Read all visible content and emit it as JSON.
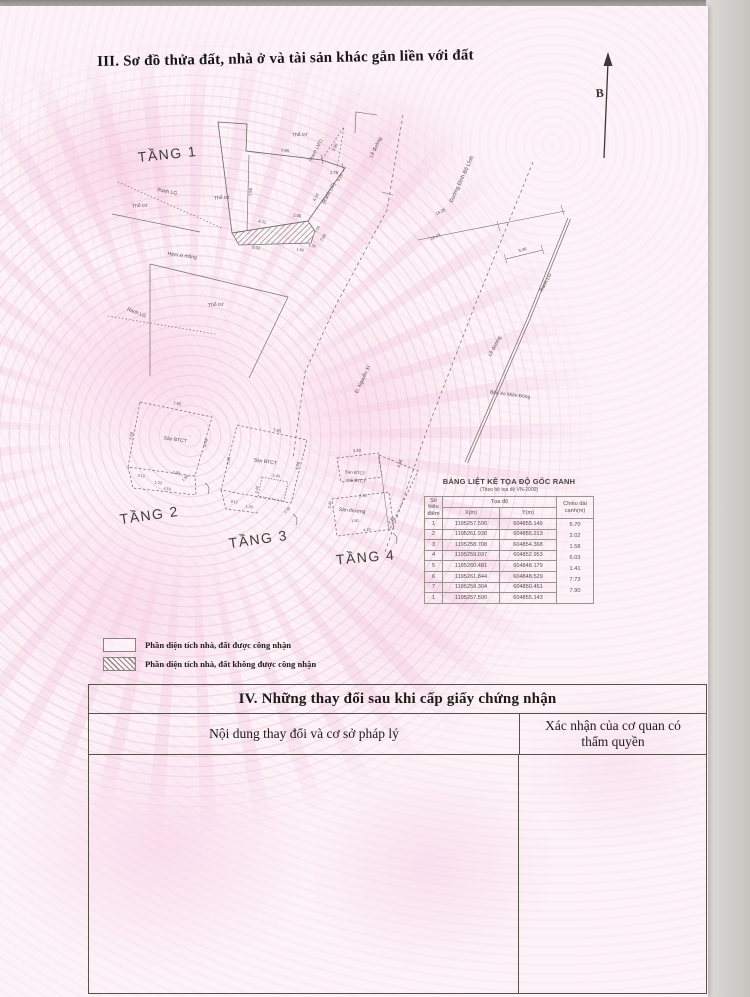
{
  "colors": {
    "paper_pink": "#fcf2f7",
    "pattern_pink": "#efc3dc",
    "line_gray": "#6b6660",
    "ink": "#1d1a17"
  },
  "header": {
    "section_title": "III. Sơ đồ thửa đất, nhà ở và tài sản khác gắn liền với đất"
  },
  "diagram": {
    "labels": [
      {
        "t": "TẦNG 1",
        "x": 168,
        "y": 159,
        "r": -6,
        "s": 14,
        "k": "floor"
      },
      {
        "t": "TẦNG 2",
        "x": 150,
        "y": 520,
        "r": -8,
        "s": 14,
        "k": "floor"
      },
      {
        "t": "TẦNG 3",
        "x": 259,
        "y": 544,
        "r": -8,
        "s": 14,
        "k": "floor"
      },
      {
        "t": "TẦNG 4",
        "x": 366,
        "y": 562,
        "r": -5,
        "s": 14,
        "k": "floor"
      },
      {
        "t": "B",
        "x": 600,
        "y": 97,
        "r": -4,
        "s": 12,
        "k": "north"
      },
      {
        "t": "Thổ cư",
        "x": 300,
        "y": 136,
        "r": -5,
        "s": 5
      },
      {
        "t": "Thổ cư",
        "x": 222,
        "y": 199,
        "r": -5,
        "s": 5
      },
      {
        "t": "Thổ cư",
        "x": 140,
        "y": 207,
        "r": -5,
        "s": 5
      },
      {
        "t": "Thổ cư",
        "x": 216,
        "y": 306,
        "r": -5,
        "s": 5
      },
      {
        "t": "Ranh LG",
        "x": 167,
        "y": 193,
        "r": 11,
        "s": 5
      },
      {
        "t": "Ranh LG",
        "x": 136,
        "y": 314,
        "r": 22,
        "s": 5
      },
      {
        "t": "(Ranh LG)",
        "x": 330,
        "y": 194,
        "r": -62,
        "s": 5
      },
      {
        "t": "Ranh LG",
        "x": 547,
        "y": 283,
        "r": -62,
        "s": 5
      },
      {
        "t": "(Ranh LMT)",
        "x": 317,
        "y": 151,
        "r": -62,
        "s": 4.6
      },
      {
        "t": "Hẻm xi măng",
        "x": 182,
        "y": 257,
        "r": 8,
        "s": 5
      },
      {
        "t": "Lề đường",
        "x": 377,
        "y": 148,
        "r": -64,
        "s": 5
      },
      {
        "t": "Lề đường",
        "x": 496,
        "y": 347,
        "r": -62,
        "s": 5
      },
      {
        "t": "Đường Đinh Bộ Lĩnh",
        "x": 463,
        "y": 180,
        "r": -65,
        "s": 5.5
      },
      {
        "t": "Bến Xe Miền Đông",
        "x": 510,
        "y": 396,
        "r": 7,
        "s": 4.8
      },
      {
        "t": "Đ. Nguyễn Xí",
        "x": 364,
        "y": 380,
        "r": -65,
        "s": 5
      },
      {
        "t": "Sàn BTCT",
        "x": 175,
        "y": 441,
        "r": 8,
        "s": 5
      },
      {
        "t": "Sàn BTCT",
        "x": 265,
        "y": 463,
        "r": 8,
        "s": 5
      },
      {
        "t": "Sàn BTCT",
        "x": 355,
        "y": 474,
        "r": 5,
        "s": 4.4
      },
      {
        "t": "mái BTCT",
        "x": 356,
        "y": 482,
        "r": 5,
        "s": 4.4
      },
      {
        "t": "Sân thượng",
        "x": 352,
        "y": 512,
        "r": 5,
        "s": 5
      },
      {
        "t": "7.95",
        "x": 285,
        "y": 152,
        "r": 4,
        "s": 4.2
      },
      {
        "t": "3.00",
        "x": 336,
        "y": 148,
        "r": -62,
        "s": 4.2
      },
      {
        "t": "1.79",
        "x": 334,
        "y": 174,
        "r": 0,
        "s": 4.2
      },
      {
        "t": "5.20",
        "x": 341,
        "y": 178,
        "r": -62,
        "s": 4.2
      },
      {
        "t": "4.10",
        "x": 317,
        "y": 198,
        "r": -60,
        "s": 4.2
      },
      {
        "t": "7.55",
        "x": 252,
        "y": 192,
        "r": -88,
        "s": 4.2
      },
      {
        "t": "4.11",
        "x": 262,
        "y": 223,
        "r": 9,
        "s": 4.2
      },
      {
        "t": "2.06",
        "x": 297,
        "y": 217,
        "r": 9,
        "s": 4.2
      },
      {
        "t": "1.06",
        "x": 318,
        "y": 230,
        "r": -55,
        "s": 3.8
      },
      {
        "t": "0.48",
        "x": 324,
        "y": 238,
        "r": -55,
        "s": 3.8
      },
      {
        "t": "1.30",
        "x": 312,
        "y": 247,
        "r": 9,
        "s": 3.8
      },
      {
        "t": "1.50",
        "x": 300,
        "y": 251,
        "r": 9,
        "s": 3.8
      },
      {
        "t": "6.02",
        "x": 256,
        "y": 249,
        "r": 9,
        "s": 4.2
      },
      {
        "t": "14.35",
        "x": 441,
        "y": 213,
        "r": -26,
        "s": 4.2
      },
      {
        "t": "28.00",
        "x": 436,
        "y": 238,
        "r": -26,
        "s": 4.2
      },
      {
        "t": "5.46",
        "x": 523,
        "y": 251,
        "r": -18,
        "s": 4.2
      },
      {
        "t": "7.95",
        "x": 177,
        "y": 405,
        "r": 8,
        "s": 4.2
      },
      {
        "t": "7.05",
        "x": 133,
        "y": 436,
        "r": -85,
        "s": 4.2
      },
      {
        "t": "4.06",
        "x": 207,
        "y": 443,
        "r": -78,
        "s": 4.2
      },
      {
        "t": "3.12",
        "x": 141,
        "y": 477,
        "r": 8,
        "s": 3.8
      },
      {
        "t": "1.20",
        "x": 158,
        "y": 484,
        "r": 8,
        "s": 3.8
      },
      {
        "t": "2.05",
        "x": 176,
        "y": 474,
        "r": 8,
        "s": 3.8
      },
      {
        "t": "1.50",
        "x": 186,
        "y": 479,
        "r": -45,
        "s": 3.8
      },
      {
        "t": "4.10",
        "x": 167,
        "y": 490,
        "r": 8,
        "s": 3.8
      },
      {
        "t": "7.95",
        "x": 277,
        "y": 432,
        "r": 8,
        "s": 4.2
      },
      {
        "t": "7.05",
        "x": 230,
        "y": 461,
        "r": -85,
        "s": 4.2
      },
      {
        "t": "4.06",
        "x": 299,
        "y": 466,
        "r": -78,
        "s": 4.2
      },
      {
        "t": "2.40",
        "x": 276,
        "y": 477,
        "r": 8,
        "s": 3.8
      },
      {
        "t": "3.40",
        "x": 258,
        "y": 490,
        "r": -80,
        "s": 3.8
      },
      {
        "t": "3.12",
        "x": 234,
        "y": 503,
        "r": 8,
        "s": 3.8
      },
      {
        "t": "1.20",
        "x": 249,
        "y": 508,
        "r": 8,
        "s": 3.8
      },
      {
        "t": "2.35",
        "x": 288,
        "y": 511,
        "r": -45,
        "s": 3.8
      },
      {
        "t": "3.40",
        "x": 357,
        "y": 452,
        "r": -3,
        "s": 4.2
      },
      {
        "t": "4.06",
        "x": 401,
        "y": 464,
        "r": -70,
        "s": 4.2
      },
      {
        "t": "2.40",
        "x": 363,
        "y": 497,
        "r": -4,
        "s": 3.8
      },
      {
        "t": "3.40",
        "x": 331,
        "y": 505,
        "r": -82,
        "s": 3.8
      },
      {
        "t": "1.50",
        "x": 355,
        "y": 522,
        "r": -4,
        "s": 3.8
      },
      {
        "t": "4.10",
        "x": 367,
        "y": 531,
        "r": -4,
        "s": 3.8
      },
      {
        "t": "2.35",
        "x": 392,
        "y": 521,
        "r": -50,
        "s": 3.8
      }
    ]
  },
  "coord_table": {
    "title": "BẢNG LIỆT KÊ TỌA ĐỘ GỐC RANH",
    "subtitle": "(Theo hệ tọa độ VN-2000)",
    "col_point": "Số hiệu điểm",
    "col_coords": "Tọa độ",
    "col_x": "X(m)",
    "col_y": "Y(m)",
    "col_length": "Chiều dài cạnh(m)",
    "rows": [
      [
        "1",
        "1195257.590",
        "604855.149"
      ],
      [
        "2",
        "1195261.930",
        "604855.213"
      ],
      [
        "3",
        "1195258.708",
        "604854.368"
      ],
      [
        "4",
        "1195259.037",
        "604852.953"
      ],
      [
        "5",
        "1195260.481",
        "604848.179"
      ],
      [
        "6",
        "1195261.844",
        "604848.529"
      ],
      [
        "7",
        "1195259.304",
        "604850.451"
      ],
      [
        "1",
        "1195257.590",
        "604855.143"
      ]
    ],
    "lengths": [
      "5.70",
      "2.02",
      "1.58",
      "6.03",
      "1.41",
      "7.73",
      "7.90"
    ]
  },
  "legend": {
    "items": [
      {
        "label": "Phần diện tích nhà, đất được công nhận",
        "hatched": false
      },
      {
        "label": "Phần diện tích nhà, đất không được công nhận",
        "hatched": true
      }
    ]
  },
  "section4": {
    "title": "IV. Những thay đổi sau khi cấp giấy chứng nhận",
    "col_content": "Nội dung thay đổi và cơ sở pháp lý",
    "col_confirm": "Xác nhận của cơ quan có thẩm quyền"
  }
}
